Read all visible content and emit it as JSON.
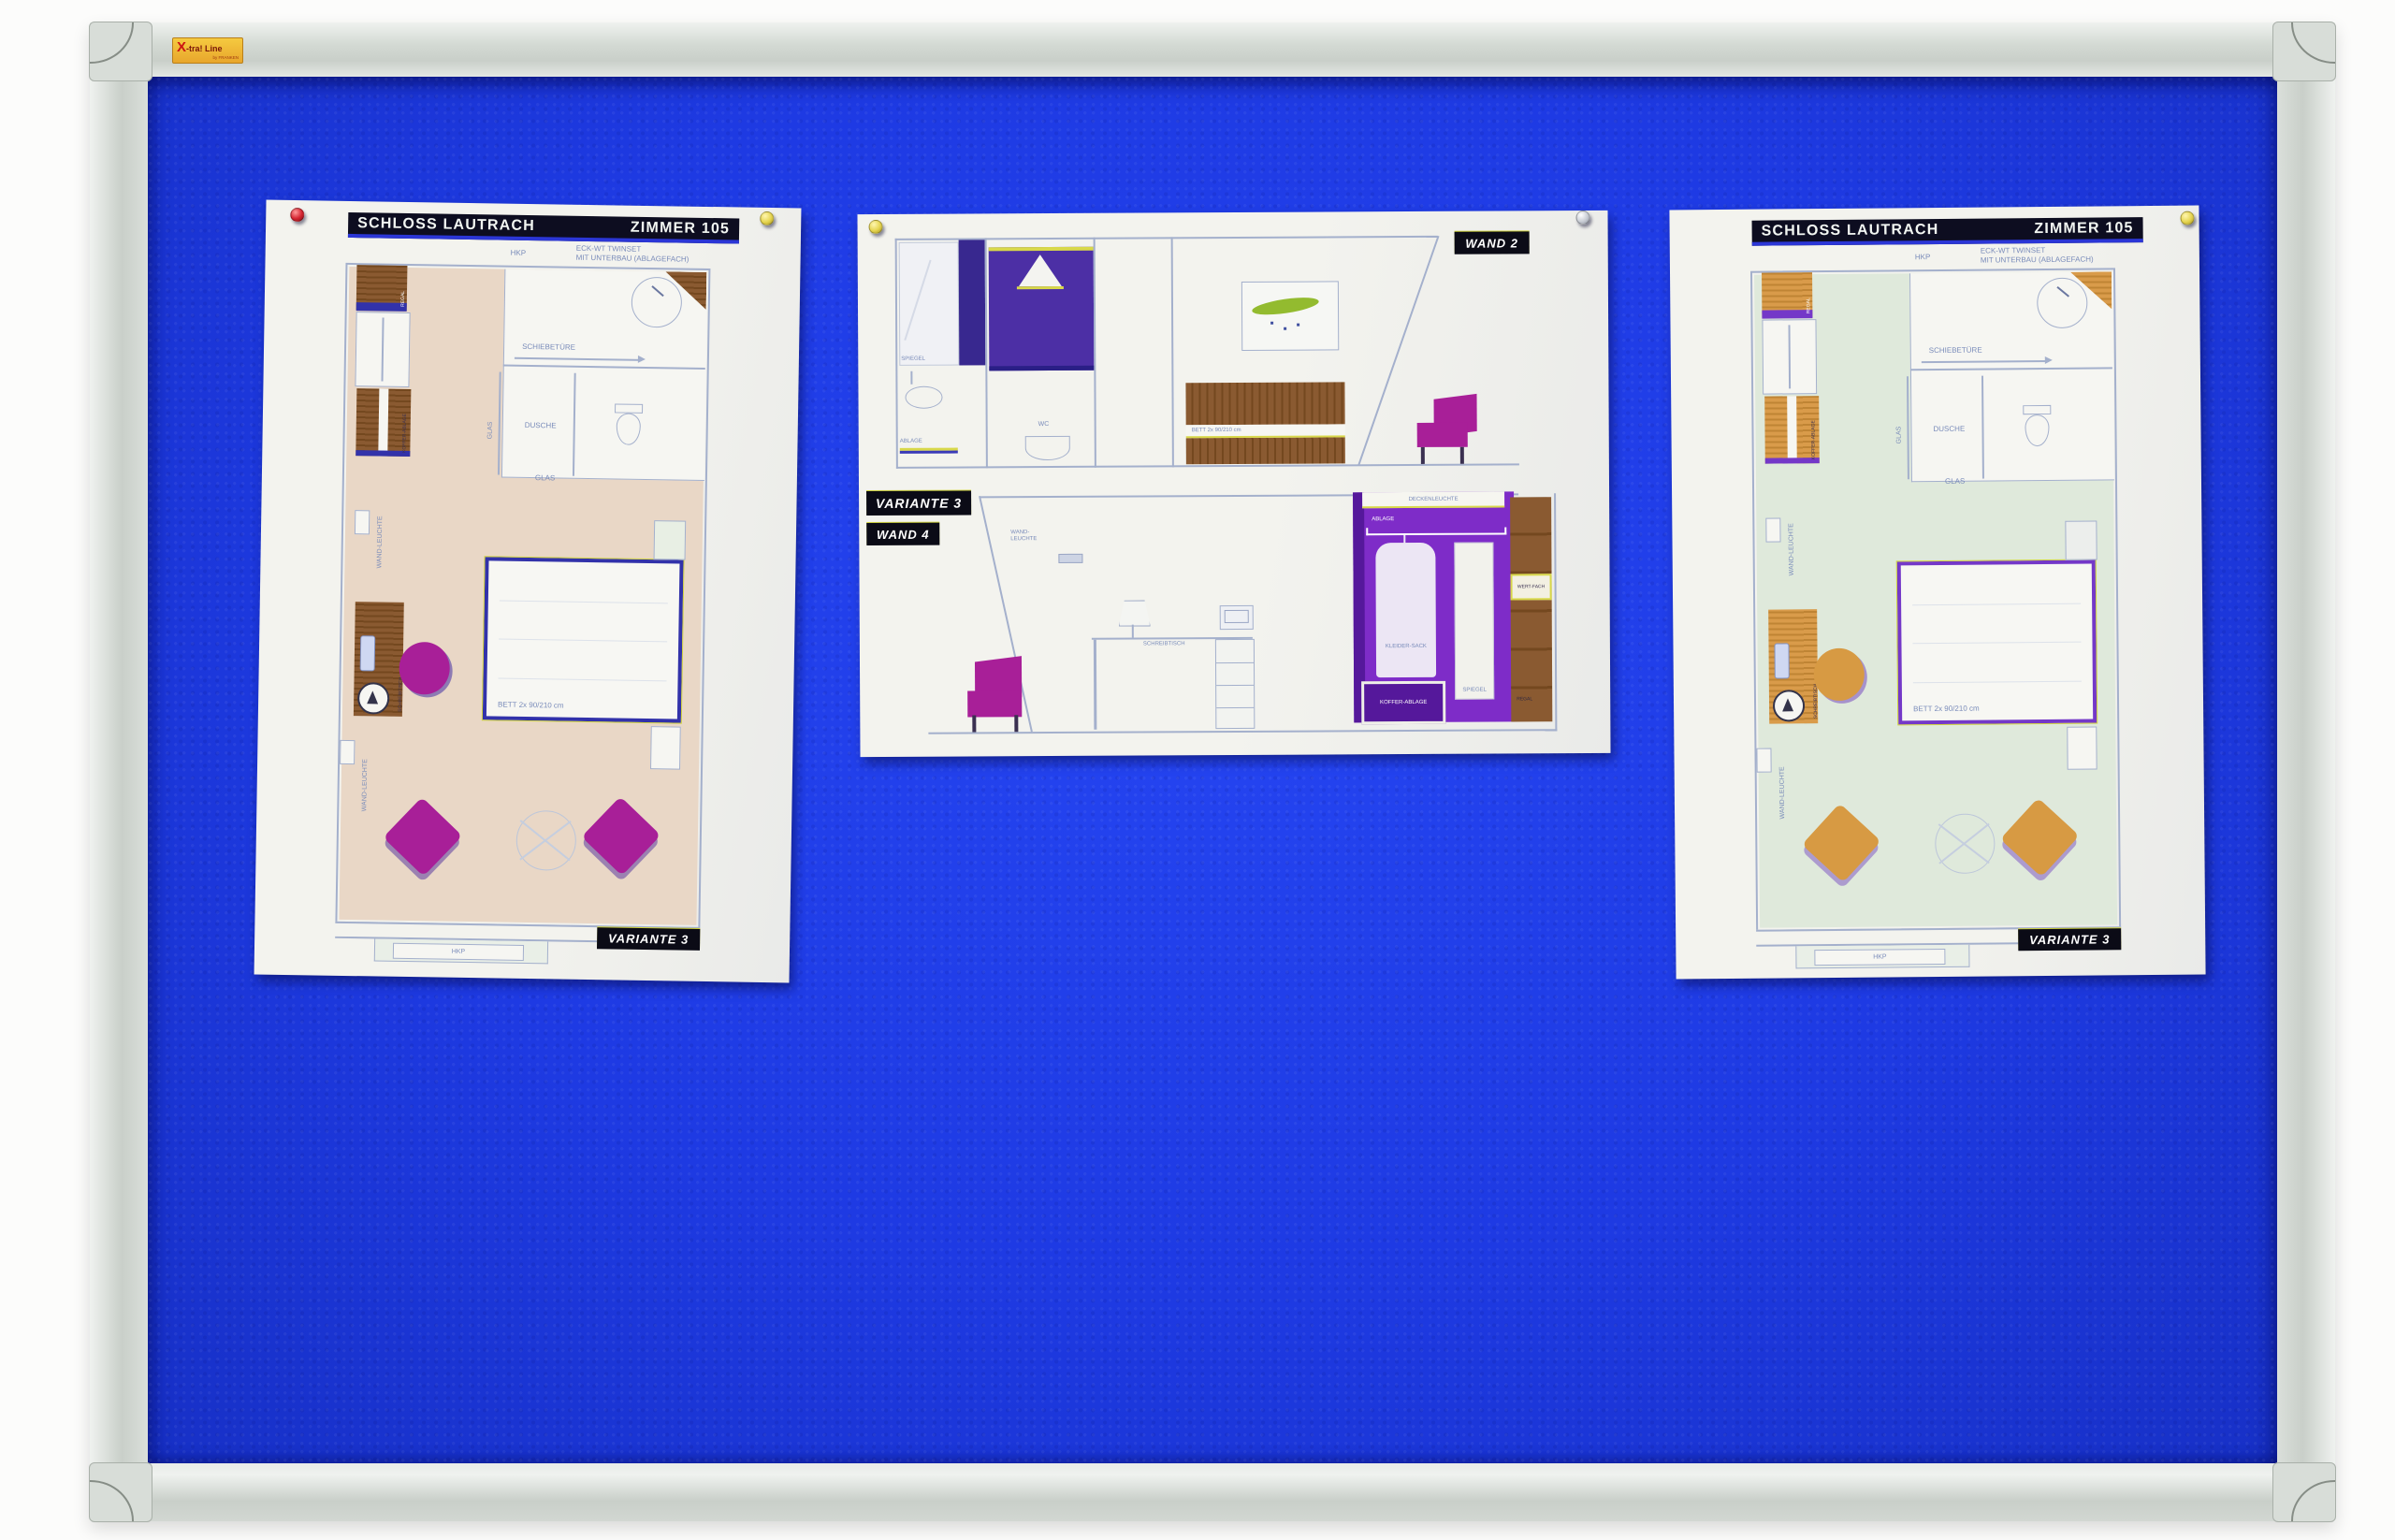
{
  "brand": {
    "x": "X",
    "name": "-tra! Line",
    "by": "by FRANKEN"
  },
  "palette": {
    "felt": "#1e3ae3",
    "feltDeep": "#1730c6",
    "frameLight": "#eff2ef",
    "frameMid": "#c9cfc9",
    "cap": "#d8ddd8",
    "paper": "#f3f3ee",
    "ink": "#0d0d20",
    "accentBlue": "#2b36d6",
    "lineBlue": "#a4b0cc",
    "labelBlue": "#7a8cba",
    "labelBg": "#0b0b16",
    "floorBeige": "#e9d7c6",
    "floorMint": "#dfe9db",
    "woodBrown": "#8a5a31",
    "woodBrownDark": "#74481f",
    "woodOrange": "#d99b4a",
    "woodOrangeDark": "#bf8434",
    "navy": "#3232aa",
    "purpleEdge": "#7438c8",
    "magenta": "#a81f98",
    "orangeSeat": "#d79a43",
    "violet": "#7e2cc8",
    "violetDark": "#55189b",
    "indigo": "#38288f",
    "shower": "#4c2fa5",
    "leafGreen": "#93bb2f",
    "pinRed": "#d42430",
    "pinYellow": "#e5d44e",
    "pinGray": "#c9cdd5"
  },
  "doc_left": {
    "title": "SCHLOSS LAUTRACH",
    "room": "ZIMMER 105",
    "note_hkp": "HKP",
    "note_line1": "ECK-WT TWINSET",
    "note_line2": "MIT UNTERBAU (ABLAGEFACH)",
    "schiebetuere": "SCHIEBETÜRE",
    "dusche": "DUSCHE",
    "glas_v": "GLAS",
    "glas_h": "GLAS",
    "wandleuchte1": "WAND-LEUCHTE",
    "wandleuchte2": "WAND-LEUCHTE",
    "regal": "REGAL",
    "koffer": "KOFFER-ABLAGE",
    "schreibtisch": "SCHREIBTISCH",
    "bett": "BETT 2x 90/210 cm",
    "hkp": "HKP",
    "variante": "VARIANTE 3"
  },
  "doc_middle": {
    "wand2": "WAND 2",
    "variante": "VARIANTE 3",
    "wand4": "WAND 4",
    "spiegel": "SPIEGEL",
    "ablage": "ABLAGE",
    "wc": "WC",
    "bett": "BETT 2x 90/210 cm",
    "wandleuchte": "WAND-LEUCHTE",
    "schreibtisch": "SCHREIBTISCH",
    "deckenleuchte": "DECKENLEUCHTE",
    "ablage2": "ABLAGE",
    "kleidersack": "KLEIDER-SACK",
    "kofferablage": "KOFFER-ABLAGE",
    "spiegel2": "SPIEGEL",
    "wertfach": "WERT-FACH",
    "regal": "REGAL"
  },
  "doc_right": {
    "title": "SCHLOSS LAUTRACH",
    "room": "ZIMMER 105",
    "note_hkp": "HKP",
    "note_line1": "ECK-WT TWINSET",
    "note_line2": "MIT UNTERBAU (ABLAGEFACH)",
    "schiebetuere": "SCHIEBETÜRE",
    "dusche": "DUSCHE",
    "glas_v": "GLAS",
    "glas_h": "GLAS",
    "wandleuchte1": "WAND-LEUCHTE",
    "wandleuchte2": "WAND-LEUCHTE",
    "regal": "REGAL",
    "koffer": "KOFFER-ABLAGE",
    "schreibtisch": "SCHREIBTISCH",
    "bett": "BETT 2x 90/210 cm",
    "hkp": "HKP",
    "variante": "VARIANTE 3"
  }
}
